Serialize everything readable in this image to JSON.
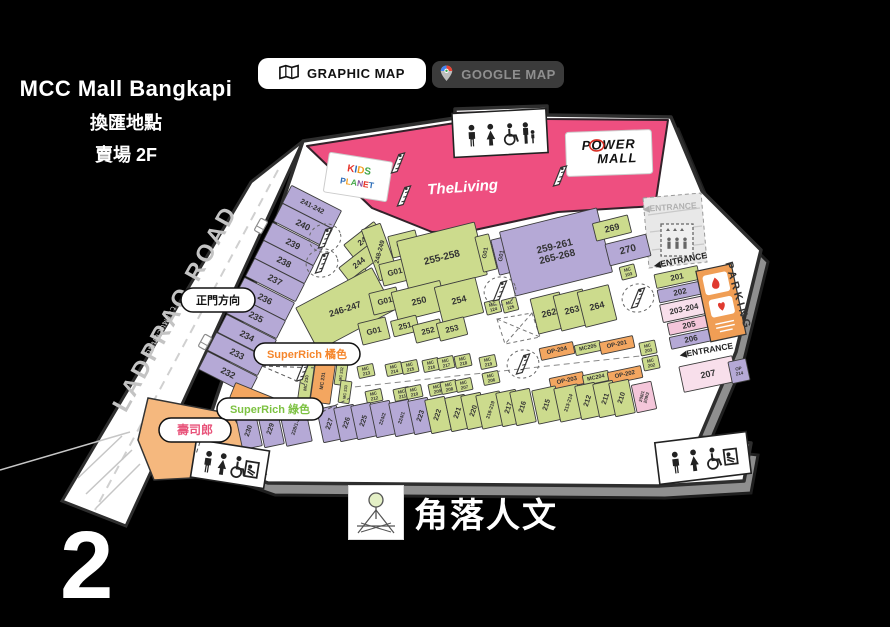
{
  "title": {
    "line1": "MCC Mall Bangkapi",
    "line2": "換匯地點",
    "line3": "賣場 2F"
  },
  "page_number": "2",
  "toolbar": {
    "graphic_map": "GRAPHIC MAP",
    "google_map": "GOOGLE MAP"
  },
  "brand": {
    "name": "角落人文"
  },
  "road": {
    "name": "LADPRAO ROAD",
    "name_thai": "ถนนลาดพร้าว"
  },
  "anchors": {
    "the_living": "TheLiving",
    "power_line1": "POWER",
    "power_line2": "MALL",
    "kids_line1": "KIDS",
    "kids_line2": "PLANET"
  },
  "labels": {
    "front_gate": "正門方向",
    "superrich_orange": "SuperRich 橘色",
    "superrich_green": "SuperRich 綠色",
    "sushiro": "壽司郎",
    "parking": "PARKING",
    "entrance": "◀ENTRANCE"
  },
  "colors": {
    "pink": "#ee4f80",
    "purple": "#b5a9d6",
    "green": "#ccdb8d",
    "orange": "#f3a660",
    "light_pink": "#f4c6da",
    "pale_pink": "#f8dfeb",
    "white": "#ffffff",
    "kids_palette": [
      "#e6332a",
      "#2b6cb8",
      "#f29c1f",
      "#44a649",
      "#8a52a0"
    ]
  },
  "map_units": [
    {
      "l": "241-242",
      "x": 312,
      "y": 207,
      "w": 56,
      "h": 20,
      "r": 27,
      "tr": 27,
      "c": "p",
      "fs": 7
    },
    {
      "l": "240",
      "x": 303,
      "y": 225,
      "w": 56,
      "h": 20,
      "r": 27,
      "tr": 27,
      "c": "p",
      "fs": 9
    },
    {
      "l": "239",
      "x": 293,
      "y": 244,
      "w": 56,
      "h": 20,
      "r": 27,
      "tr": 27,
      "c": "p",
      "fs": 9
    },
    {
      "l": "238",
      "x": 284,
      "y": 262,
      "w": 56,
      "h": 20,
      "r": 27,
      "tr": 27,
      "c": "p",
      "fs": 9
    },
    {
      "l": "237",
      "x": 275,
      "y": 280,
      "w": 56,
      "h": 20,
      "r": 27,
      "tr": 27,
      "c": "p",
      "fs": 9
    },
    {
      "l": "236",
      "x": 265,
      "y": 299,
      "w": 56,
      "h": 20,
      "r": 27,
      "tr": 27,
      "c": "p",
      "fs": 9
    },
    {
      "l": "235",
      "x": 256,
      "y": 317,
      "w": 56,
      "h": 20,
      "r": 27,
      "tr": 27,
      "c": "p",
      "fs": 9
    },
    {
      "l": "234",
      "x": 247,
      "y": 336,
      "w": 56,
      "h": 20,
      "r": 27,
      "tr": 27,
      "c": "p",
      "fs": 9
    },
    {
      "l": "233",
      "x": 237,
      "y": 354,
      "w": 56,
      "h": 20,
      "r": 27,
      "tr": 27,
      "c": "p",
      "fs": 9
    },
    {
      "l": "232",
      "x": 228,
      "y": 373,
      "w": 56,
      "h": 20,
      "r": 27,
      "tr": 27,
      "c": "p",
      "fs": 9
    },
    {
      "l": "243",
      "x": 364,
      "y": 240,
      "w": 38,
      "h": 17,
      "r": -38,
      "tr": -38,
      "c": "g",
      "fs": 8
    },
    {
      "l": "244",
      "x": 359,
      "y": 263,
      "w": 38,
      "h": 17,
      "r": -38,
      "tr": -38,
      "c": "g",
      "fs": 8
    },
    {
      "l": "245",
      "x": 355,
      "y": 287,
      "w": 38,
      "h": 17,
      "r": -38,
      "tr": -38,
      "c": "g",
      "fs": 8
    },
    {
      "l": "246-247",
      "x": 345,
      "y": 309,
      "w": 86,
      "h": 48,
      "r": -28,
      "tr": -18,
      "c": "g",
      "fs": 9
    },
    {
      "l": "248-249",
      "x": 380,
      "y": 252,
      "w": 20,
      "h": 54,
      "r": -20,
      "tr": -75,
      "c": "g",
      "fs": 6.5
    },
    {
      "l": "G01",
      "x": 404,
      "y": 244,
      "w": 28,
      "h": 22,
      "r": -14,
      "c": "g",
      "fs": 8
    },
    {
      "l": "G01",
      "x": 395,
      "y": 272,
      "w": 28,
      "h": 22,
      "r": -14,
      "c": "g",
      "fs": 8
    },
    {
      "l": "G01",
      "x": 385,
      "y": 301,
      "w": 28,
      "h": 22,
      "r": -14,
      "c": "g",
      "fs": 8
    },
    {
      "l": "G01",
      "x": 374,
      "y": 331,
      "w": 28,
      "h": 22,
      "r": -14,
      "c": "g",
      "fs": 8
    },
    {
      "l": "255-258",
      "x": 442,
      "y": 258,
      "w": 80,
      "h": 54,
      "r": -14,
      "c": "g",
      "fs": 10
    },
    {
      "l": "250",
      "x": 419,
      "y": 301,
      "w": 50,
      "h": 30,
      "r": -14,
      "c": "g",
      "fs": 9
    },
    {
      "l": "254",
      "x": 459,
      "y": 300,
      "w": 42,
      "h": 36,
      "r": -14,
      "c": "g",
      "fs": 9
    },
    {
      "l": "251",
      "x": 405,
      "y": 326,
      "w": 26,
      "h": 16,
      "r": -14,
      "c": "g",
      "fs": 8
    },
    {
      "l": "252",
      "x": 428,
      "y": 331,
      "w": 28,
      "h": 18,
      "r": -14,
      "c": "g",
      "fs": 8
    },
    {
      "l": "253",
      "x": 452,
      "y": 329,
      "w": 28,
      "h": 18,
      "r": -14,
      "c": "g",
      "fs": 8
    },
    {
      "l": "G01",
      "x": 486,
      "y": 253,
      "w": 14,
      "h": 36,
      "r": -14,
      "tr": -80,
      "c": "g",
      "fs": 6
    },
    {
      "l": "G01",
      "x": 502,
      "y": 256,
      "w": 14,
      "h": 36,
      "r": -14,
      "tr": -80,
      "c": "p",
      "fs": 6
    },
    {
      "l": "259-261\n265-268",
      "x": 556,
      "y": 252,
      "w": 100,
      "h": 66,
      "r": -14,
      "c": "p",
      "fs": 10
    },
    {
      "l": "269",
      "x": 612,
      "y": 228,
      "w": 36,
      "h": 18,
      "r": -14,
      "c": "g",
      "fs": 9
    },
    {
      "l": "270",
      "x": 628,
      "y": 250,
      "w": 42,
      "h": 22,
      "r": -14,
      "c": "p",
      "fs": 10
    },
    {
      "l": "262",
      "x": 549,
      "y": 313,
      "w": 30,
      "h": 36,
      "r": -14,
      "c": "g",
      "fs": 9
    },
    {
      "l": "263",
      "x": 572,
      "y": 310,
      "w": 30,
      "h": 36,
      "r": -14,
      "c": "g",
      "fs": 9
    },
    {
      "l": "264",
      "x": 597,
      "y": 306,
      "w": 32,
      "h": 36,
      "r": -14,
      "c": "g",
      "fs": 9
    },
    {
      "l": "MC\n124",
      "x": 493,
      "y": 307,
      "w": 15,
      "h": 13,
      "r": -14,
      "c": "g",
      "fs": 4.5
    },
    {
      "l": "MC\n125",
      "x": 510,
      "y": 305,
      "w": 15,
      "h": 13,
      "r": -14,
      "c": "g",
      "fs": 4.5
    },
    {
      "l": "MC\n103",
      "x": 628,
      "y": 272,
      "w": 15,
      "h": 13,
      "r": -14,
      "c": "g",
      "fs": 4.5
    },
    {
      "l": "201",
      "x": 677,
      "y": 277,
      "w": 44,
      "h": 14,
      "r": -12,
      "c": "g",
      "fs": 8
    },
    {
      "l": "202",
      "x": 680,
      "y": 292,
      "w": 44,
      "h": 13,
      "r": -12,
      "c": "p",
      "fs": 8
    },
    {
      "l": "203-204",
      "x": 684,
      "y": 309,
      "w": 46,
      "h": 18,
      "r": -12,
      "c": "lp",
      "fs": 8
    },
    {
      "l": "205",
      "x": 689,
      "y": 325,
      "w": 42,
      "h": 12,
      "r": -12,
      "c": "k",
      "fs": 8
    },
    {
      "l": "206",
      "x": 691,
      "y": 339,
      "w": 42,
      "h": 12,
      "r": -12,
      "c": "p",
      "fs": 8
    },
    {
      "l": "207",
      "x": 708,
      "y": 374,
      "w": 54,
      "h": 26,
      "r": -12,
      "c": "lp",
      "fs": 9
    },
    {
      "l": "OP\n214",
      "x": 739,
      "y": 371,
      "w": 18,
      "h": 22,
      "r": -12,
      "c": "p",
      "fs": 4.5
    },
    {
      "l": "MC\n203",
      "x": 648,
      "y": 348,
      "w": 16,
      "h": 13,
      "r": -12,
      "c": "g",
      "fs": 4.5
    },
    {
      "l": "MC\n202",
      "x": 651,
      "y": 363,
      "w": 16,
      "h": 13,
      "r": -12,
      "c": "g",
      "fs": 4.5
    },
    {
      "l": "208/1\n209/2",
      "x": 644,
      "y": 397,
      "w": 20,
      "h": 28,
      "r": -12,
      "tr": -75,
      "c": "k",
      "fs": 4.5
    },
    {
      "l": "MC\n213",
      "x": 366,
      "y": 371,
      "w": 16,
      "h": 12,
      "r": -12,
      "c": "g",
      "fs": 4.5
    },
    {
      "l": "MC\n214",
      "x": 394,
      "y": 369,
      "w": 16,
      "h": 12,
      "r": -12,
      "c": "g",
      "fs": 4.5
    },
    {
      "l": "MC\n215",
      "x": 410,
      "y": 367,
      "w": 16,
      "h": 12,
      "r": -12,
      "c": "g",
      "fs": 4.5
    },
    {
      "l": "MC\n216",
      "x": 431,
      "y": 365,
      "w": 16,
      "h": 12,
      "r": -12,
      "c": "g",
      "fs": 4.5
    },
    {
      "l": "MC\n217",
      "x": 446,
      "y": 363,
      "w": 16,
      "h": 12,
      "r": -12,
      "c": "g",
      "fs": 4.5
    },
    {
      "l": "MC\n218",
      "x": 463,
      "y": 361,
      "w": 16,
      "h": 12,
      "r": -12,
      "c": "g",
      "fs": 4.5
    },
    {
      "l": "MC\n219",
      "x": 488,
      "y": 362,
      "w": 16,
      "h": 12,
      "r": -12,
      "c": "g",
      "fs": 4.5
    },
    {
      "l": "MC\n212",
      "x": 374,
      "y": 396,
      "w": 16,
      "h": 12,
      "r": -12,
      "c": "g",
      "fs": 4.5
    },
    {
      "l": "MC\n211",
      "x": 402,
      "y": 394,
      "w": 16,
      "h": 12,
      "r": -12,
      "c": "g",
      "fs": 4.5
    },
    {
      "l": "MC\n210",
      "x": 414,
      "y": 392,
      "w": 16,
      "h": 12,
      "r": -12,
      "c": "g",
      "fs": 4.5
    },
    {
      "l": "MC\n209",
      "x": 437,
      "y": 389,
      "w": 16,
      "h": 12,
      "r": -12,
      "c": "g",
      "fs": 4.5
    },
    {
      "l": "MC\n208",
      "x": 449,
      "y": 387,
      "w": 16,
      "h": 12,
      "r": -12,
      "c": "g",
      "fs": 4.5
    },
    {
      "l": "MC\n207",
      "x": 464,
      "y": 385,
      "w": 16,
      "h": 12,
      "r": -12,
      "c": "g",
      "fs": 4.5
    },
    {
      "l": "MC\n206",
      "x": 491,
      "y": 378,
      "w": 16,
      "h": 12,
      "r": -12,
      "c": "g",
      "fs": 4.5
    },
    {
      "l": "OP-204",
      "x": 557,
      "y": 351,
      "w": 34,
      "h": 12,
      "r": -12,
      "c": "o",
      "fs": 6
    },
    {
      "l": "MC205",
      "x": 588,
      "y": 348,
      "w": 26,
      "h": 10,
      "r": -12,
      "c": "g",
      "fs": 5.5
    },
    {
      "l": "OP-201",
      "x": 617,
      "y": 345,
      "w": 34,
      "h": 12,
      "r": -12,
      "c": "o",
      "fs": 6
    },
    {
      "l": "OP-203",
      "x": 567,
      "y": 381,
      "w": 34,
      "h": 12,
      "r": -12,
      "c": "o",
      "fs": 6
    },
    {
      "l": "MC204",
      "x": 596,
      "y": 378,
      "w": 26,
      "h": 10,
      "r": -12,
      "c": "g",
      "fs": 5.5
    },
    {
      "l": "OP-202",
      "x": 625,
      "y": 375,
      "w": 34,
      "h": 12,
      "r": -12,
      "c": "o",
      "fs": 6
    },
    {
      "l": "MC 230",
      "x": 306,
      "y": 383,
      "w": 12,
      "h": 40,
      "r": 8,
      "tr": -82,
      "c": "g",
      "fs": 4.5
    },
    {
      "l": "MC 231",
      "x": 323,
      "y": 381,
      "w": 20,
      "h": 44,
      "r": 8,
      "tr": -82,
      "c": "o",
      "fs": 5
    },
    {
      "l": "MC 232",
      "x": 341,
      "y": 374,
      "w": 11,
      "h": 22,
      "r": 8,
      "tr": -82,
      "c": "g",
      "fs": 4
    },
    {
      "l": "MC 233",
      "x": 345,
      "y": 392,
      "w": 11,
      "h": 22,
      "r": 8,
      "tr": -82,
      "c": "g",
      "fs": 4
    },
    {
      "l": "",
      "x": 255,
      "y": 399,
      "w": 48,
      "h": 16,
      "r": 22,
      "c": "o",
      "fs": 6
    },
    {
      "l": "230",
      "x": 249,
      "y": 431,
      "w": 20,
      "h": 34,
      "r": -12,
      "tr": -72,
      "c": "p",
      "fs": 7
    },
    {
      "l": "229",
      "x": 271,
      "y": 429,
      "w": 20,
      "h": 34,
      "r": -12,
      "tr": -72,
      "c": "p",
      "fs": 7
    },
    {
      "l": "228/1-2",
      "x": 296,
      "y": 427,
      "w": 26,
      "h": 34,
      "r": -12,
      "tr": -72,
      "c": "p",
      "fs": 5
    },
    {
      "l": "227",
      "x": 330,
      "y": 424,
      "w": 20,
      "h": 34,
      "r": -12,
      "tr": -72,
      "c": "p",
      "fs": 7
    },
    {
      "l": "226",
      "x": 347,
      "y": 423,
      "w": 20,
      "h": 34,
      "r": -12,
      "tr": -72,
      "c": "p",
      "fs": 7
    },
    {
      "l": "225",
      "x": 364,
      "y": 421,
      "w": 20,
      "h": 34,
      "r": -12,
      "tr": -72,
      "c": "p",
      "fs": 7
    },
    {
      "l": "224/2",
      "x": 383,
      "y": 419,
      "w": 20,
      "h": 34,
      "r": -12,
      "tr": -72,
      "c": "p",
      "fs": 5
    },
    {
      "l": "224/1",
      "x": 402,
      "y": 418,
      "w": 20,
      "h": 34,
      "r": -12,
      "tr": -72,
      "c": "p",
      "fs": 5
    },
    {
      "l": "223",
      "x": 421,
      "y": 416,
      "w": 20,
      "h": 34,
      "r": -12,
      "tr": -72,
      "c": "p",
      "fs": 7
    },
    {
      "l": "222",
      "x": 438,
      "y": 415,
      "w": 20,
      "h": 34,
      "r": -12,
      "tr": -72,
      "c": "g",
      "fs": 7
    },
    {
      "l": "221",
      "x": 458,
      "y": 413,
      "w": 20,
      "h": 34,
      "r": -12,
      "tr": -72,
      "c": "g",
      "fs": 7
    },
    {
      "l": "220",
      "x": 474,
      "y": 411,
      "w": 20,
      "h": 34,
      "r": -12,
      "tr": -72,
      "c": "g",
      "fs": 7
    },
    {
      "l": "218-219",
      "x": 491,
      "y": 410,
      "w": 24,
      "h": 34,
      "r": -12,
      "tr": -72,
      "c": "g",
      "fs": 5
    },
    {
      "l": "217",
      "x": 509,
      "y": 408,
      "w": 20,
      "h": 34,
      "r": -12,
      "tr": -72,
      "c": "g",
      "fs": 7
    },
    {
      "l": "216",
      "x": 523,
      "y": 407,
      "w": 20,
      "h": 34,
      "r": -12,
      "tr": -72,
      "c": "g",
      "fs": 7
    },
    {
      "l": "215",
      "x": 547,
      "y": 405,
      "w": 24,
      "h": 34,
      "r": -12,
      "tr": -72,
      "c": "g",
      "fs": 7
    },
    {
      "l": "213-214",
      "x": 569,
      "y": 403,
      "w": 24,
      "h": 34,
      "r": -12,
      "tr": -72,
      "c": "g",
      "fs": 5
    },
    {
      "l": "212",
      "x": 588,
      "y": 401,
      "w": 20,
      "h": 34,
      "r": -12,
      "tr": -72,
      "c": "g",
      "fs": 7
    },
    {
      "l": "211",
      "x": 606,
      "y": 399,
      "w": 20,
      "h": 34,
      "r": -12,
      "tr": -72,
      "c": "g",
      "fs": 7
    },
    {
      "l": "210",
      "x": 622,
      "y": 398,
      "w": 20,
      "h": 34,
      "r": -12,
      "tr": -72,
      "c": "g",
      "fs": 7
    }
  ],
  "icons": {
    "escalators": [
      {
        "x": 398,
        "y": 163
      },
      {
        "x": 404,
        "y": 196
      },
      {
        "x": 560,
        "y": 176
      },
      {
        "x": 325,
        "y": 238,
        "d": 1
      },
      {
        "x": 322,
        "y": 263,
        "d": 1
      },
      {
        "x": 303,
        "y": 371
      },
      {
        "x": 500,
        "y": 291,
        "d": 1
      },
      {
        "x": 638,
        "y": 298,
        "d": 1
      },
      {
        "x": 523,
        "y": 364,
        "d": 1
      }
    ],
    "restrooms": [
      {
        "x": 500,
        "y": 133,
        "w": 94,
        "h": 44,
        "r": -3,
        "icons": [
          "man-icon",
          "woman-icon",
          "wheelchair-icon",
          "family-icon"
        ]
      },
      {
        "x": 230,
        "y": 464,
        "w": 74,
        "h": 38,
        "r": 9,
        "icons": [
          "man-icon",
          "woman-icon",
          "wheelchair-icon",
          "baby-icon"
        ]
      },
      {
        "x": 703,
        "y": 458,
        "w": 92,
        "h": 42,
        "r": -7,
        "icons": [
          "man-icon",
          "woman-icon",
          "wheelchair-icon",
          "baby-icon"
        ]
      }
    ],
    "cars": [
      {
        "x": 261,
        "y": 226
      },
      {
        "x": 205,
        "y": 342
      }
    ]
  }
}
